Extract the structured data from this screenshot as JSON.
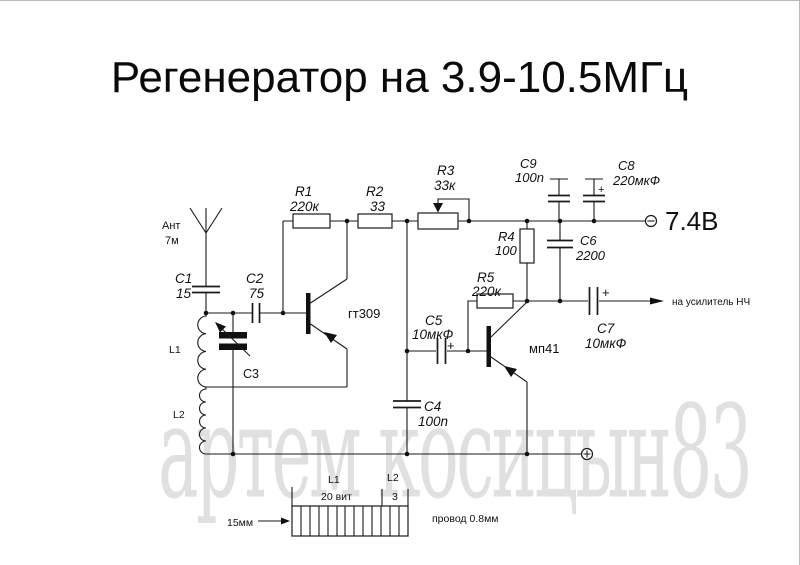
{
  "title": "Регенератор на 3.9-10.5МГц",
  "watermark": "артем косицын83",
  "colors": {
    "ink": "#1a1a1a",
    "background": "#ffffff",
    "watermark": "#e4e4e4"
  },
  "antenna": {
    "label": "Ант",
    "length": "7м"
  },
  "resistors": {
    "r1": {
      "ref": "R1",
      "val": "220к"
    },
    "r2": {
      "ref": "R2",
      "val": "33"
    },
    "r3": {
      "ref": "R3",
      "val": "33к"
    },
    "r4": {
      "ref": "R4",
      "val": "100"
    },
    "r5": {
      "ref": "R5",
      "val": "220к"
    }
  },
  "capacitors": {
    "c1": {
      "ref": "C1",
      "val": "15"
    },
    "c2": {
      "ref": "C2",
      "val": "75"
    },
    "c3": {
      "ref": "C3"
    },
    "c4": {
      "ref": "C4",
      "val": "100n"
    },
    "c5": {
      "ref": "C5",
      "val": "10мкФ"
    },
    "c6": {
      "ref": "C6",
      "val": "2200"
    },
    "c7": {
      "ref": "C7",
      "val": "10мкФ"
    },
    "c8": {
      "ref": "C8",
      "val": "220мкФ"
    },
    "c9": {
      "ref": "C9",
      "val": "100n"
    }
  },
  "inductors": {
    "l1": "L1",
    "l2": "L2"
  },
  "transistors": {
    "q1": "гт309",
    "q2": "мп41"
  },
  "supply": {
    "voltage": "7.4В"
  },
  "output_label": "на усилитель НЧ",
  "winding": {
    "l1": "L1",
    "l1_turns": "20 вит",
    "l2": "L2",
    "l2_turns": "3",
    "former_dia": "15мм",
    "wire": "провод 0.8мм"
  },
  "symbols": {
    "plus": "+"
  }
}
